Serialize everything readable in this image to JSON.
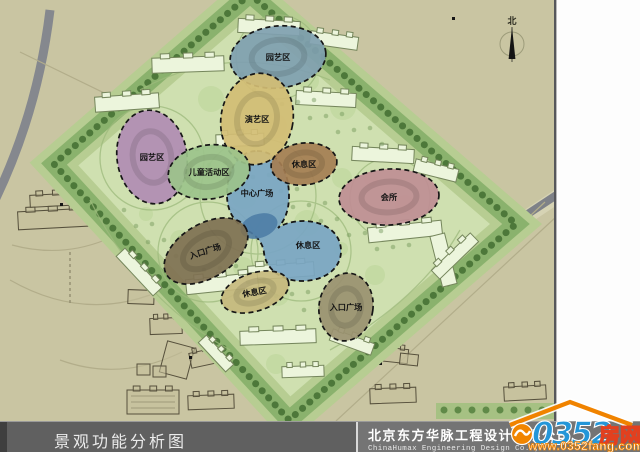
{
  "title_bar": {
    "title": "景观功能分析图",
    "company_cn": "北京东方华脉工程设计有限公司",
    "company_en": "ChinaHumax Engineering Design Co. ,"
  },
  "watermark": {
    "number": "0352",
    "suffix": "房网",
    "url": "www.0352fang.com",
    "accent_orange": "#f08300",
    "accent_blue": "#2496d8"
  },
  "map": {
    "north_label": "北",
    "background_color": "#c9c5a2",
    "site_green": "#cfe0b0",
    "zones": [
      {
        "id": "garden-top",
        "label": "园艺区",
        "color": "#7f9fb0",
        "cx": 278,
        "cy": 57,
        "rx": 48,
        "ry": 31,
        "rot": -6,
        "label_rot": 0
      },
      {
        "id": "performance",
        "label": "演艺区",
        "color": "#d3bd74",
        "cx": 257,
        "cy": 119,
        "rx": 36,
        "ry": 46,
        "rot": 10,
        "label_rot": 0
      },
      {
        "id": "garden-left",
        "label": "园艺区",
        "color": "#b18cb3",
        "cx": 152,
        "cy": 157,
        "rx": 35,
        "ry": 47,
        "rot": -8,
        "label_rot": 0
      },
      {
        "id": "children",
        "label": "儿童活动区",
        "color": "#9cc38b",
        "cx": 209,
        "cy": 172,
        "rx": 41,
        "ry": 27,
        "rot": -8,
        "label_rot": 0
      },
      {
        "id": "rest-ne",
        "label": "休息区",
        "color": "#a57e53",
        "cx": 304,
        "cy": 164,
        "rx": 33,
        "ry": 21,
        "rot": -6,
        "label_rot": 0
      },
      {
        "id": "club",
        "label": "会所",
        "color": "#bf8e94",
        "cx": 389,
        "cy": 197,
        "rx": 50,
        "ry": 28,
        "rot": -3,
        "label_rot": 0
      },
      {
        "id": "entrance-w",
        "label": "入口广场",
        "color": "#7f7153",
        "cx": 206,
        "cy": 251,
        "rx": 46,
        "ry": 27,
        "rot": -31,
        "label_rot": -18
      },
      {
        "id": "rest-s",
        "label": "休息区",
        "color": "#c6b97d",
        "cx": 255,
        "cy": 292,
        "rx": 35,
        "ry": 19,
        "rot": -18,
        "label_rot": -10
      },
      {
        "id": "entrance-se",
        "label": "入口广场",
        "color": "#9a9170",
        "cx": 346,
        "cy": 307,
        "rx": 27,
        "ry": 34,
        "rot": 8,
        "label_rot": 0
      }
    ],
    "plaza_blob": {
      "color": "#7aa6c3",
      "pond_color": "#4e7da6",
      "label_top": "中心广场",
      "label_top_xy": [
        257,
        196
      ],
      "label_bottom": "休息区",
      "label_bottom_xy": [
        308,
        248
      ]
    }
  }
}
